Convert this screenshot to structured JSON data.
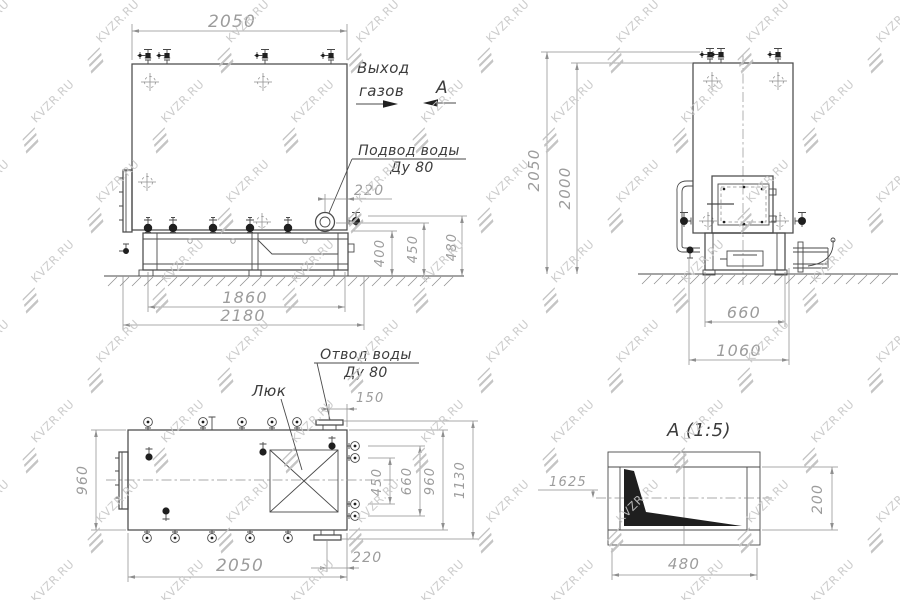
{
  "watermark": {
    "text": "KVZR.RU",
    "text_color": "#c7c7c7",
    "logo_color": "#bfbfbf"
  },
  "colors": {
    "main_line": "#4a4a4a",
    "thin_line": "#8f8f8f",
    "dim_text": "#9c9c9c",
    "label_text": "#3c3c3c",
    "fill_dark": "#1f1f1f",
    "background": "#ffffff"
  },
  "views": {
    "side": {
      "dims": {
        "width_top": "2050",
        "flange_offset": "220",
        "h_base": "400",
        "h_flange": "450",
        "h_valve": "480",
        "base_inner": "1860",
        "base_outer": "2180"
      },
      "labels": {
        "gas_out_1": "Выход",
        "gas_out_2": "газов",
        "view_marker": "А",
        "water_in_1": "Подвод воды",
        "water_in_2": "Ду 80"
      }
    },
    "front": {
      "dims": {
        "height_total": "2050",
        "height_body": "2000",
        "base_width": "660",
        "overall_width": "1060"
      }
    },
    "plan": {
      "dims": {
        "depth_left": "960",
        "outlet_offset": "150",
        "stubs_inner": "450",
        "stubs_outer": "660",
        "depth_right": "960",
        "overall_right": "1130",
        "outlet_bottom_offset": "220",
        "length": "2050"
      },
      "labels": {
        "hatch": "Люк",
        "water_out_1": "Отвод воды",
        "water_out_2": "Ду 80"
      }
    },
    "detail": {
      "title": "А  (1:5)",
      "dims": {
        "callout": "1625",
        "height": "200",
        "width": "480"
      }
    }
  }
}
